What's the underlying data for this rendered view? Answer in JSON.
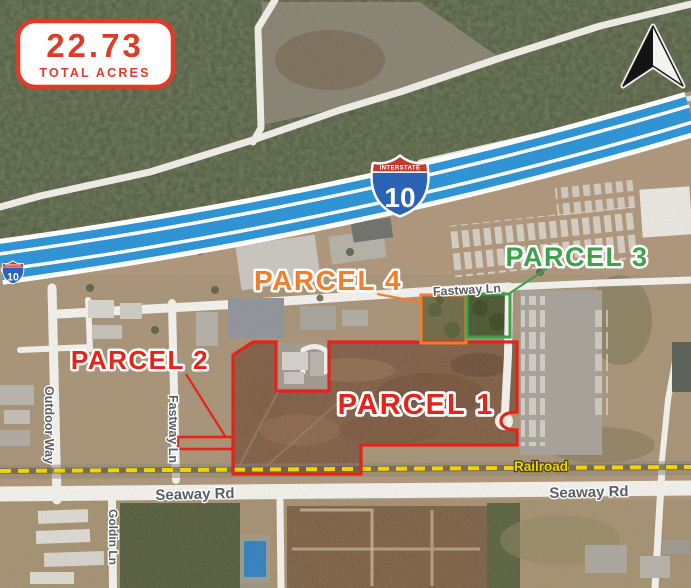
{
  "badge": {
    "value": "22.73",
    "caption": "TOTAL ACRES",
    "accent_color": "#de3b28"
  },
  "parcels": {
    "p1": {
      "label": "PARCEL 1",
      "color": "#e2241a"
    },
    "p2": {
      "label": "PARCEL 2",
      "color": "#e2241a"
    },
    "p3": {
      "label": "PARCEL 3",
      "color": "#3fa24a"
    },
    "p4": {
      "label": "PARCEL 4",
      "color": "#f07e2d"
    }
  },
  "highway": {
    "shield_caption": "INTERSTATE",
    "shield_number": "10",
    "highlight_color": "#2f93d4"
  },
  "roads": {
    "fastway_ln_horizontal": "Fastway Ln",
    "fastway_ln_vertical": "Fastway Ln",
    "outdoor_way": "Outdoor Way",
    "goldin_ln": "Goldin Ln",
    "seaway_rd_left": "Seaway Rd",
    "seaway_rd_right": "Seaway Rd"
  },
  "railroad": {
    "label": "Railroad",
    "color": "#f2d303"
  },
  "icons": {
    "north_arrow": "north-arrow",
    "interstate_shield": "interstate-10-shield"
  }
}
